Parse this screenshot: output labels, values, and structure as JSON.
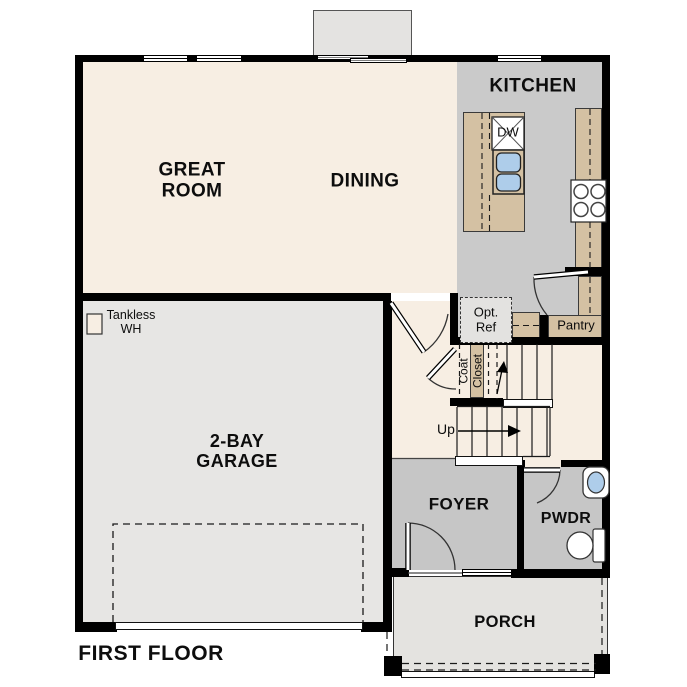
{
  "title": "FIRST FLOOR",
  "colors": {
    "wall": "#000000",
    "floor_main": "#f7eee3",
    "floor_kitchen": "#cacaca",
    "floor_foyer": "#c6c6c6",
    "floor_garage": "#e7e6e4",
    "floor_porch": "#e4e3e0",
    "counter": "#d4c1a3",
    "sink_blue": "#aecdea"
  },
  "rooms": {
    "great_room": {
      "label": "GREAT\nROOM"
    },
    "dining": {
      "label": "DINING"
    },
    "kitchen": {
      "label": "KITCHEN"
    },
    "garage": {
      "label": "2-BAY\nGARAGE"
    },
    "foyer": {
      "label": "FOYER"
    },
    "powder": {
      "label": "PWDR"
    },
    "porch": {
      "label": "PORCH"
    },
    "pantry": {
      "label": "Pantry"
    }
  },
  "fixtures": {
    "dishwasher": {
      "label": "DW"
    },
    "optional_refrigerator": {
      "label": "Opt.\nRef"
    },
    "tankless_water_heater": {
      "label": "Tankless\nWH"
    },
    "coat_closet": {
      "label_line1": "Coat",
      "label_line2": "Closet"
    },
    "stairs": {
      "label": "Up"
    }
  }
}
